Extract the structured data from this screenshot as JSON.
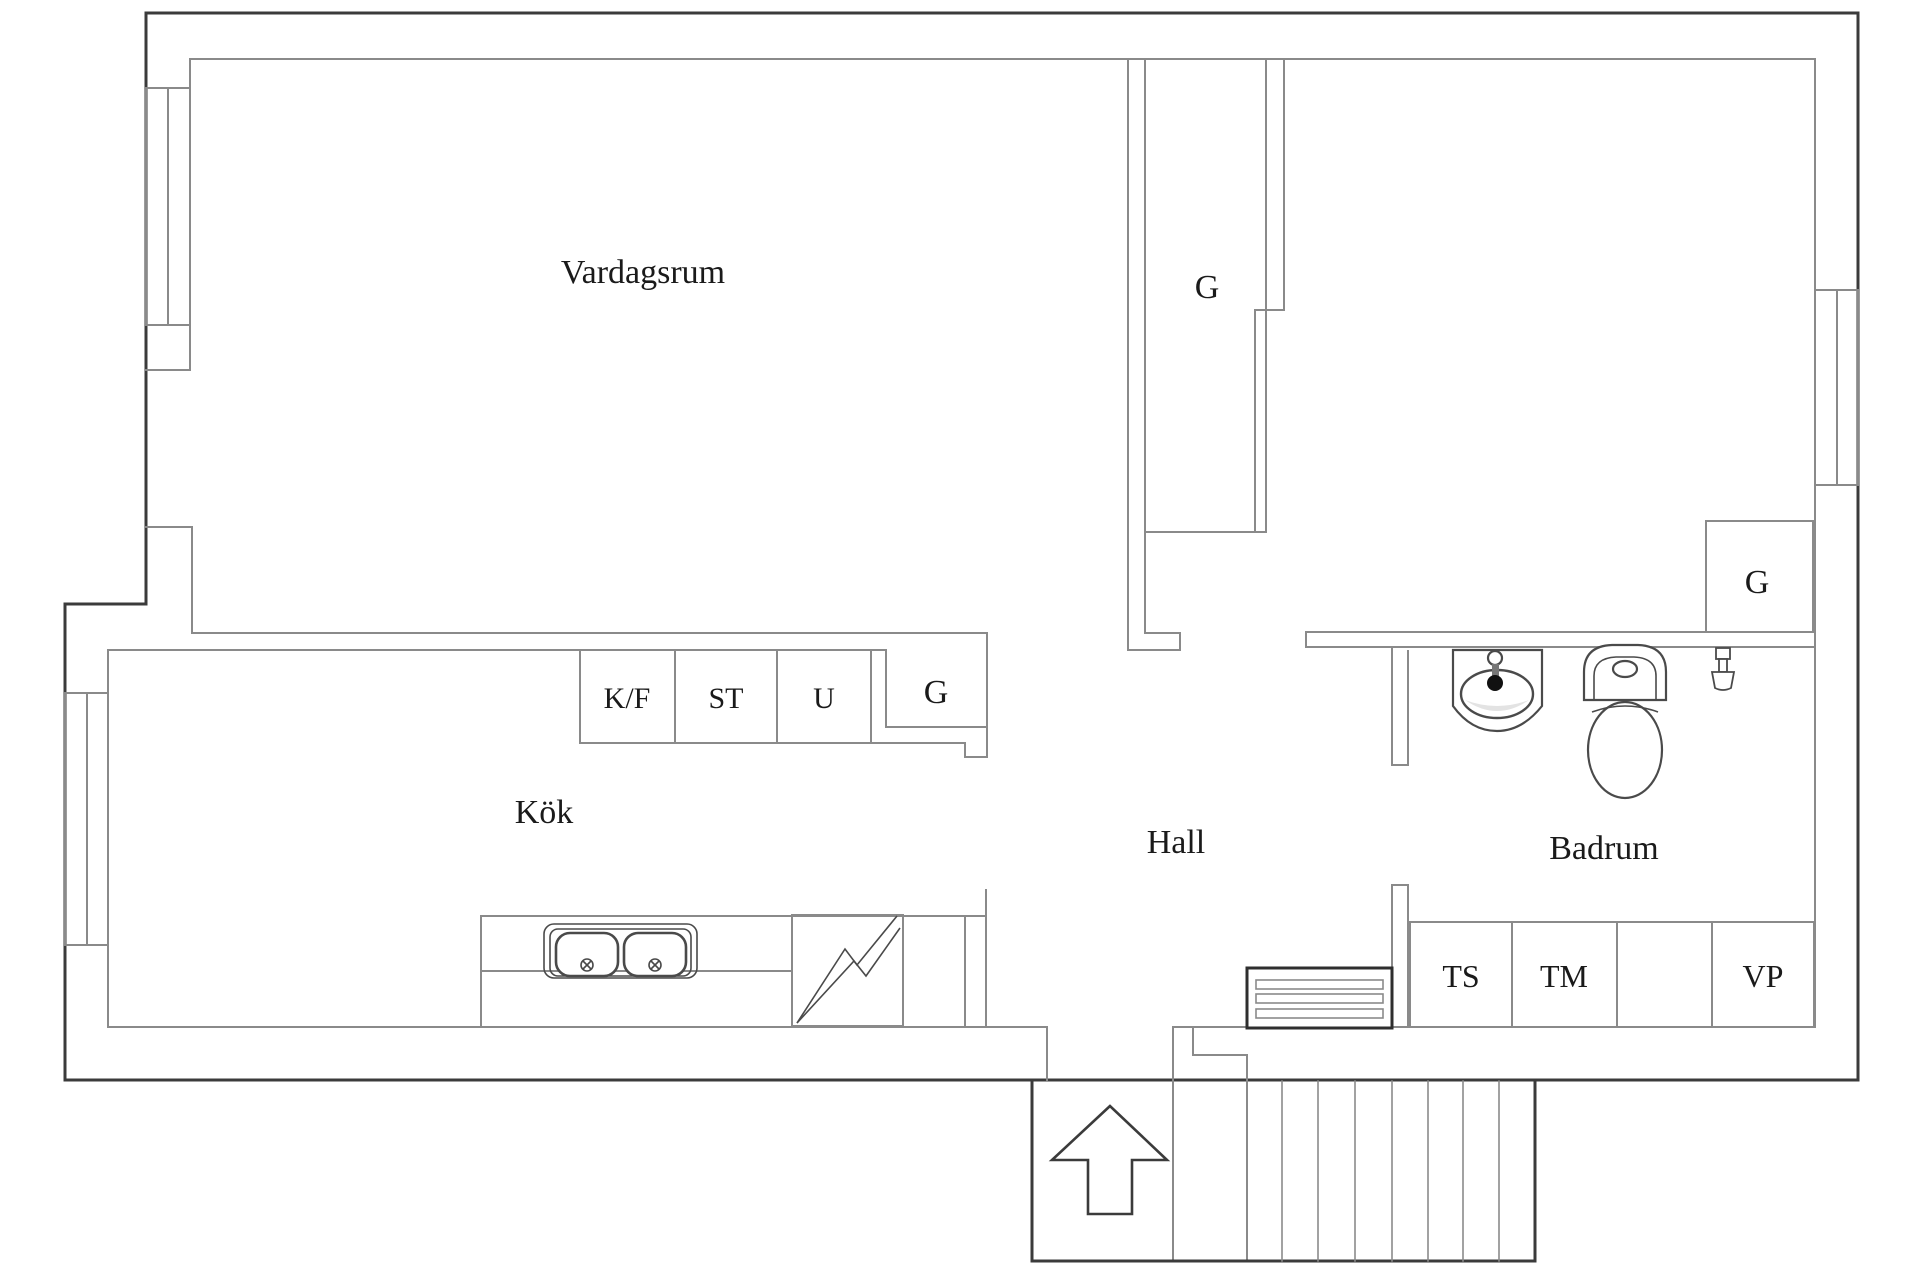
{
  "plan": {
    "rooms": {
      "living": "Vardagsrum",
      "kitchen": "Kök",
      "hall": "Hall",
      "bathroom": "Badrum"
    },
    "closets": {
      "middle": "G",
      "kitchen": "G",
      "bedroom": "G"
    },
    "appliances": {
      "fridge_freezer": "K/F",
      "pantry": "ST",
      "oven": "U",
      "drying_cabinet": "TS",
      "washing_machine": "TM",
      "water_heater": "VP"
    },
    "icons": {
      "entrance_arrow": "arrow-up-icon",
      "stairs": "stairs-icon",
      "vent_grille": "vent-grille-icon",
      "kitchen_sink": "double-sink-icon",
      "stove": "lightning-icon",
      "bathroom_sink": "washbasin-icon",
      "toilet": "toilet-icon",
      "valve": "tap-valve-icon"
    },
    "colors": {
      "wall_dark": "#3b3b3b",
      "wall_gray": "#8a8a8a",
      "text": "#1a1a1a",
      "background": "#ffffff"
    }
  }
}
